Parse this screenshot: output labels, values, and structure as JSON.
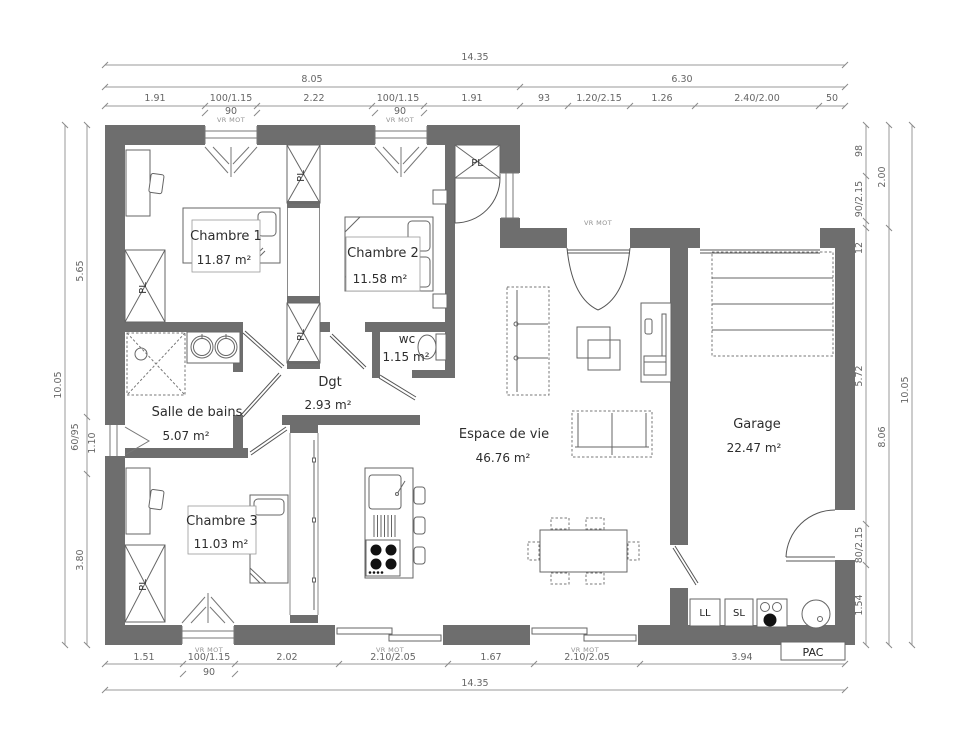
{
  "plan": {
    "rooms": {
      "chambre1": {
        "name": "Chambre 1",
        "area": "11.87 m²"
      },
      "chambre2": {
        "name": "Chambre 2",
        "area": "11.58 m²"
      },
      "chambre3": {
        "name": "Chambre 3",
        "area": "11.03 m²"
      },
      "sdb": {
        "name": "Salle de bains",
        "area": "5.07 m²"
      },
      "wc": {
        "name": "wc",
        "area": "1.15 m²"
      },
      "dgt": {
        "name": "Dgt",
        "area": "2.93 m²"
      },
      "vie": {
        "name": "Espace de vie",
        "area": "46.76 m²"
      },
      "garage": {
        "name": "Garage",
        "area": "22.47 m²"
      }
    },
    "tags": {
      "vr_mot": "VR MOT",
      "pl": "PL",
      "pac": "PAC",
      "ll": "LL",
      "sl": "SL"
    },
    "dims": {
      "top": {
        "total": "14.35",
        "span_left": "8.05",
        "span_right": "6.30",
        "sub": "90",
        "segs": [
          "1.91",
          "100/1.15",
          "2.22",
          "100/1.15",
          "1.91",
          "93",
          "1.20/2.15",
          "1.26",
          "2.40/2.00",
          "50"
        ]
      },
      "bottom": {
        "total": "14.35",
        "sub": "90",
        "segs": [
          "1.51",
          "100/1.15",
          "2.02",
          "2.10/2.05",
          "1.67",
          "2.10/2.05",
          "3.94"
        ]
      },
      "left": {
        "total": "10.05",
        "segs": [
          "5.65",
          "60/95",
          "1.10",
          "3.80"
        ]
      },
      "right": {
        "outer": "10.05",
        "mid": [
          "2.00",
          "8.06"
        ],
        "segs": [
          "98",
          "90/2.15",
          "12",
          "5.72",
          "80/2.15",
          "1.54"
        ]
      }
    },
    "colors": {
      "wall": "#6e6e6e",
      "dim_text": "#666666",
      "room_text": "#2d2d2d"
    }
  }
}
